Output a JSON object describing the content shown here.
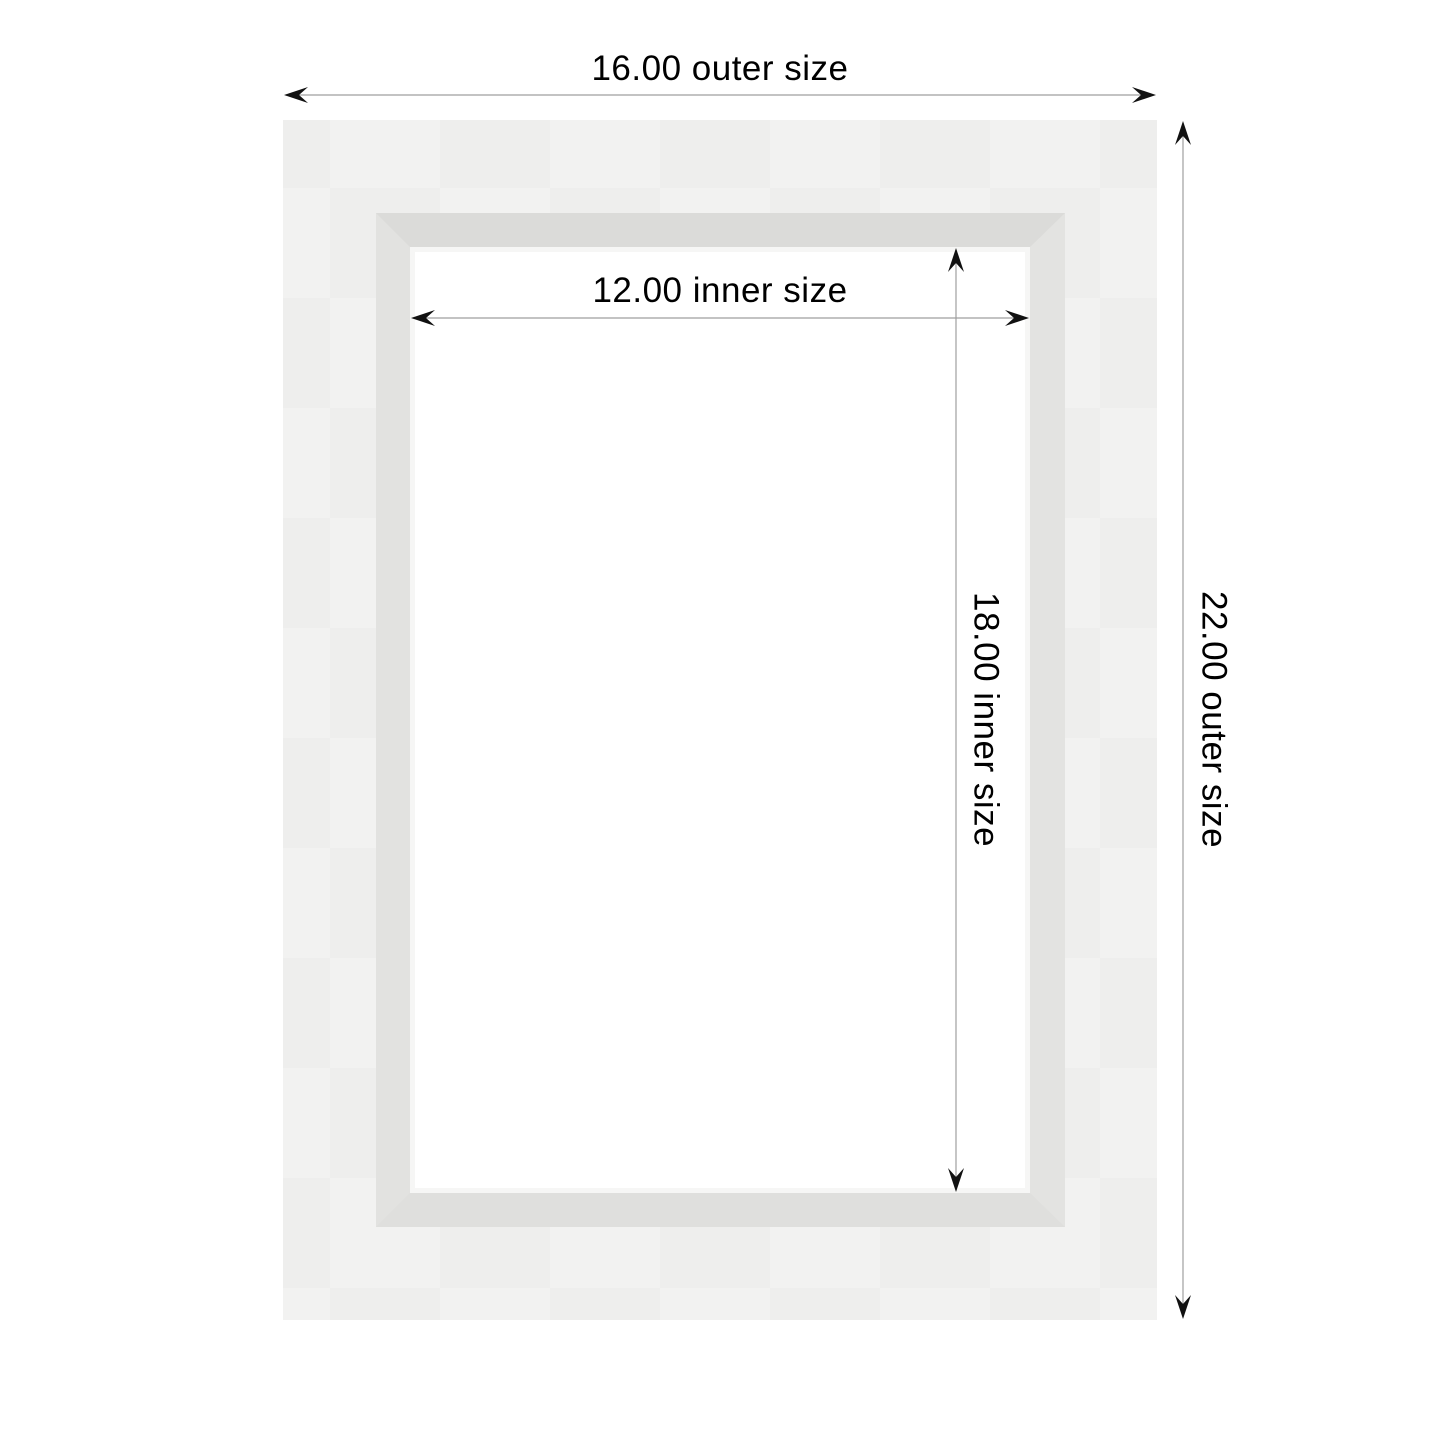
{
  "diagram": {
    "type": "frame-dimension-diagram",
    "labels": {
      "outer_width": "16.00 outer size",
      "outer_height": "22.00 outer size",
      "inner_width": "12.00 inner size",
      "inner_height": "18.00 inner size"
    },
    "values": {
      "outer_width": 16.0,
      "outer_height": 22.0,
      "inner_width": 12.0,
      "inner_height": 18.0
    },
    "colors": {
      "page_background": "#ffffff",
      "mat_face": "#f0f0ef",
      "molding_top": "#dbdbd9",
      "molding_side": "#e2e2e0",
      "bevel_highlight": "#f6f6f5",
      "opening": "#ffffff",
      "dimension_line": "#9f9f9f",
      "arrow": "#111111",
      "text": "#000000"
    }
  }
}
